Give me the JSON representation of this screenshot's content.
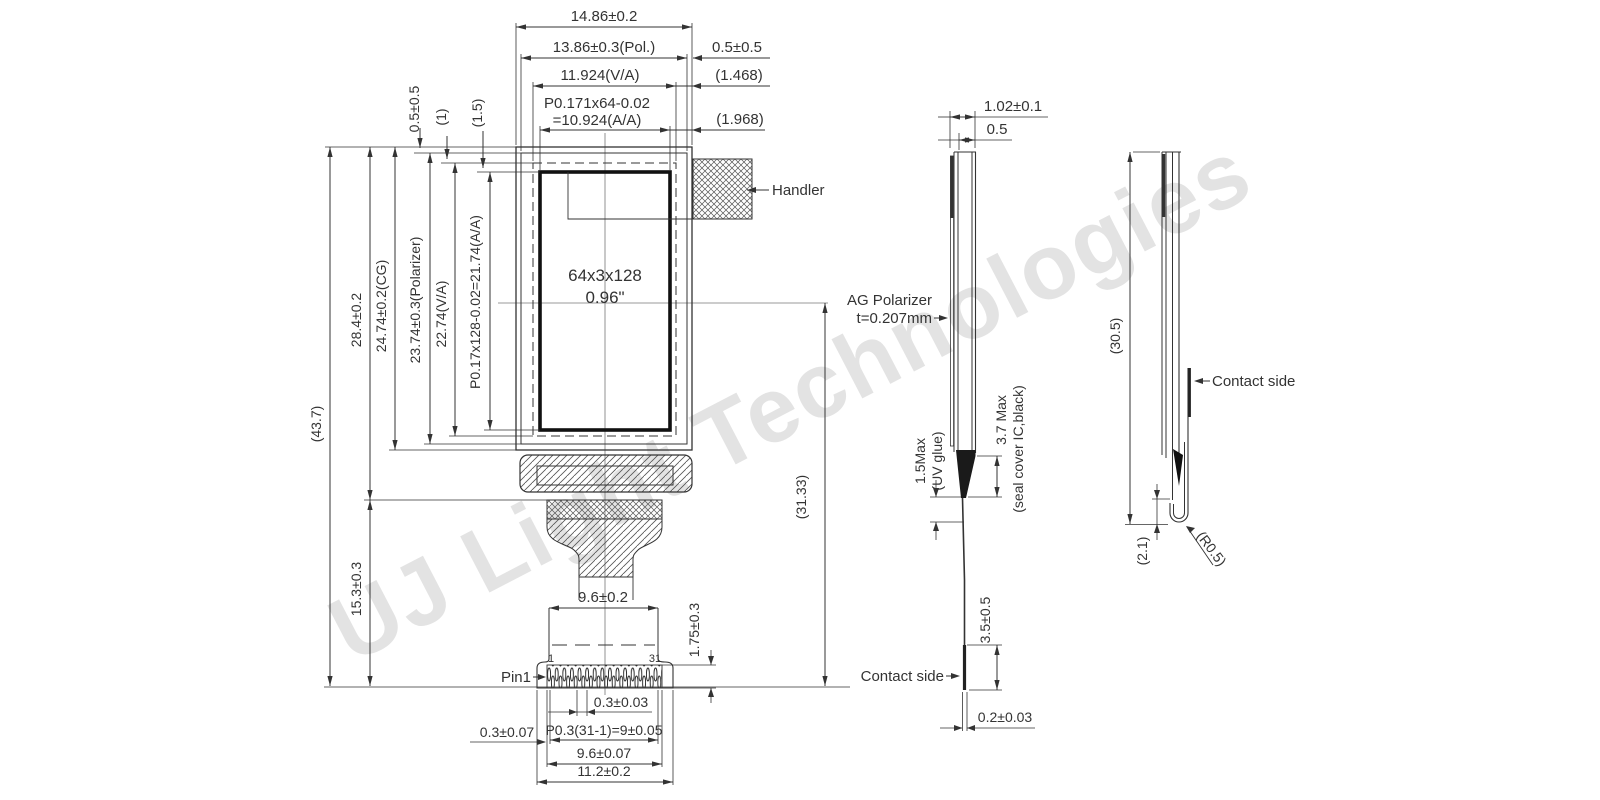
{
  "watermark": "UJ Light Technologies",
  "front_view": {
    "top_dims": {
      "overall_width": "14.86±0.2",
      "polarizer_width": "13.86±0.3(Pol.)",
      "va_width": "11.924(V/A)",
      "aa_width_line1": "P0.171x64-0.02",
      "aa_width_line2": "=10.924(A/A)",
      "right_margin": "0.5±0.5",
      "va_right_margin": "(1.468)",
      "aa_right_margin": "(1.968)"
    },
    "left_dims": {
      "overall_height": "(43.7)",
      "panel_height": "28.4±0.2",
      "tail_height": "15.3±0.3",
      "cg_height": "24.74±0.2(CG)",
      "polarizer_height": "23.74±0.3(Polarizer)",
      "va_height": "22.74(V/A)",
      "aa_height": "P0.17x128-0.02=21.74(A/A)",
      "top_margin": "0.5±0.5",
      "gap1": "(1)",
      "gap2": "(1.5)"
    },
    "display": {
      "resolution": "64x3x128",
      "size": "0.96\""
    },
    "handler_label": "Handler",
    "center_to_bottom": "(31.33)",
    "bottom_dims": {
      "fpc_width": "9.6±0.2",
      "pin_length": "1.75±0.3",
      "pin1_label": "Pin1",
      "pin_first": "1",
      "pin_last": "31",
      "pin_width": "0.3±0.03",
      "pin_pitch": "P0.3(31-1)=9±0.05",
      "edge_margin": "0.3±0.07",
      "contact_width": "9.6±0.07",
      "connector_width": "11.2±0.2"
    }
  },
  "side_view": {
    "total_thickness": "1.02±0.1",
    "glass_thickness": "0.5",
    "polarizer_line1": "AG Polarizer",
    "polarizer_line2": "t=0.207mm",
    "uv_glue_line1": "1.5Max",
    "uv_glue_line2": "(UV glue)",
    "seal_line1": "3.7 Max",
    "seal_line2": "(seal cover IC,black)",
    "contact_height": "3.5±0.5",
    "contact_label": "Contact side",
    "fpc_thickness": "0.2±0.03"
  },
  "folded_view": {
    "height": "(30.5)",
    "contact_label": "Contact side",
    "fold_height": "(2.1)",
    "bend_radius": "(R0.5)"
  }
}
